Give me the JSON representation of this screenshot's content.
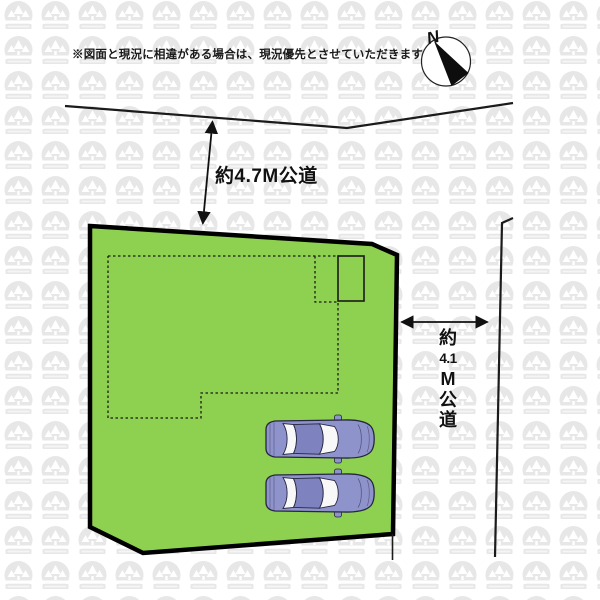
{
  "canvas": {
    "width": 600,
    "height": 600,
    "background": "#ffffff"
  },
  "disclaimer": {
    "text": "※図面と現況に相違がある場合は、現況優先とさせていただきます"
  },
  "compass": {
    "label": "N"
  },
  "dimension_labels": {
    "top_road": "約4.7M公道",
    "right_road": "約4.1M公道",
    "right_road_chars": [
      "約",
      "4.1",
      "M",
      "公",
      "道"
    ]
  },
  "plot": {
    "parked_cars": 2
  },
  "colors": {
    "plot_fill": "#8ed04f",
    "line": "#000000",
    "car_body": "#8f93cb",
    "car_roof": "#7e83bf",
    "car_window": "#f8f8f8",
    "watermark": "#e7e7e7"
  }
}
